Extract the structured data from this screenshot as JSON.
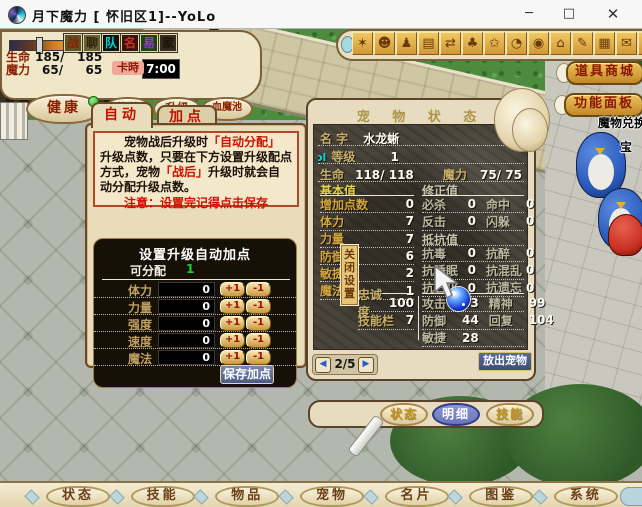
{
  "colors": {
    "accent_red": "#c01000",
    "gold_button": "#d8a840",
    "active_tab_blue": "#6a76b8",
    "hp_text": "#8b2000",
    "alloc_green": "#22cc22"
  },
  "titlebar": {
    "title": "月下魔力 [ 怀旧区1]--YoLo",
    "minimize": "─",
    "maximize": "□",
    "close": "✕"
  },
  "hud": {
    "hp_label": "生命",
    "hp_cur": "185/",
    "hp_max": "185",
    "mp_label": "魔力",
    "mp_cur": "65/",
    "mp_max": "65",
    "time_label": "卡時",
    "time_value": "7:00",
    "squares": [
      "战",
      "聊",
      "队",
      "名",
      "易",
      "家"
    ],
    "buttons": [
      "健康",
      "信件",
      "升级",
      "血魔池"
    ]
  },
  "toolbar": {
    "icons": [
      {
        "name": "battle-icon",
        "glyph": "✶"
      },
      {
        "name": "chat-icon",
        "glyph": "☻"
      },
      {
        "name": "team-icon",
        "glyph": "♟"
      },
      {
        "name": "profile-card-icon",
        "glyph": "▤"
      },
      {
        "name": "trade-icon",
        "glyph": "⇄"
      },
      {
        "name": "community-icon",
        "glyph": "♣"
      },
      {
        "name": "action-emote-icon",
        "glyph": "✩"
      },
      {
        "name": "compass-clock-icon",
        "glyph": "◔"
      },
      {
        "name": "observe-eye-icon",
        "glyph": "◉"
      },
      {
        "name": "shop-stall-icon",
        "glyph": "⌂"
      },
      {
        "name": "sign-pen-icon",
        "glyph": "✎"
      },
      {
        "name": "camera-icon",
        "glyph": "▦"
      },
      {
        "name": "memo-icon",
        "glyph": "✉"
      },
      {
        "name": "tools-icon",
        "glyph": "⚒"
      }
    ]
  },
  "side": {
    "shop_button": "道具商城",
    "panel_button": "功能面板",
    "npc_label_1": "魔物兑换",
    "npc_label_2": "宝"
  },
  "auto_dialog": {
    "tab_auto": "自动",
    "tab_manual": "加点",
    "info_1": "宠物战后升级时",
    "info_red_1": "「自动分配」",
    "info_2": "升级点数，只要在下方设置升级配点方式，宠物",
    "info_red_2": "「战后」",
    "info_3": "升级时就会自动分配升级点数。",
    "note": "注意：设置完记得点击保存",
    "panel": {
      "title": "设置升级自动加点",
      "alloc_label": "可分配",
      "alloc_value": "1",
      "rows": [
        {
          "label": "体力",
          "value": "0"
        },
        {
          "label": "力量",
          "value": "0"
        },
        {
          "label": "强度",
          "value": "0"
        },
        {
          "label": "速度",
          "value": "0"
        },
        {
          "label": "魔法",
          "value": "0"
        }
      ],
      "plus": "+1",
      "minus": "-1",
      "save": "保存加点"
    }
  },
  "pet_window": {
    "title": "宠 物 状 态",
    "close_strip": "关闭设置",
    "artifact": "ol",
    "name_label": "名  字",
    "name_value": "水龙蜥",
    "level_label": "等级",
    "level_value": "1",
    "hp_label": "生命",
    "hp_value": "118/ 118",
    "mp_label": "魔力",
    "mp_value": "75/ 75",
    "base_header": "基本值",
    "mod_header": "修正值",
    "resist_header": "抵抗值",
    "base_stats": [
      {
        "label": "增加点数",
        "value": "0"
      },
      {
        "label": "体力",
        "value": "7"
      },
      {
        "label": "力量",
        "value": "7"
      },
      {
        "label": "防御",
        "value": "6"
      },
      {
        "label": "敏捷",
        "value": "2"
      },
      {
        "label": "魔法",
        "value": "1"
      }
    ],
    "mod_stats": [
      {
        "l1": "必杀",
        "v1": "0",
        "l2": "命中",
        "v2": "0"
      },
      {
        "l1": "反击",
        "v1": "0",
        "l2": "闪躲",
        "v2": "0"
      }
    ],
    "resists": [
      {
        "l1": "抗毒",
        "v1": "0",
        "l2": "抗醉",
        "v2": "0"
      },
      {
        "l1": "抗睡眠",
        "v1": "0",
        "l2": "抗混乱",
        "v2": "0"
      },
      {
        "l1": "抗石化",
        "v1": "0",
        "l2": "抗遗忘",
        "v2": "0"
      }
    ],
    "loyalty_label": "忠诚度",
    "loyalty_value": "100",
    "skillbar_label": "技能栏",
    "skillbar_value": "7",
    "combat": [
      {
        "l1": "攻击",
        "v1": "43",
        "l2": "精神",
        "v2": "99"
      },
      {
        "l1": "防御",
        "v1": "44",
        "l2": "回复",
        "v2": "104"
      },
      {
        "l1": "敏捷",
        "v1": "28",
        "l2": "",
        "v2": ""
      }
    ],
    "pager": "2/5",
    "release_button": "放出宠物",
    "tabs": [
      "状态",
      "明细",
      "技能"
    ]
  },
  "bottom_bar": {
    "items": [
      "状态",
      "技能",
      "物品",
      "宠物",
      "名片",
      "图鉴",
      "系统"
    ]
  }
}
